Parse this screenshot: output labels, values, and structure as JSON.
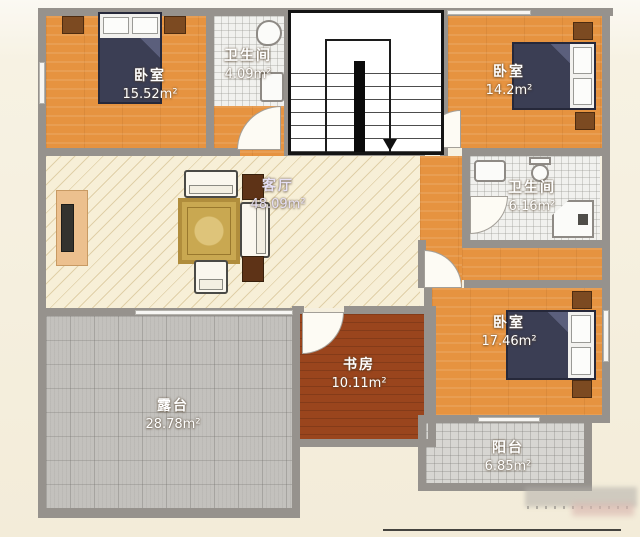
{
  "plan": {
    "type": "floor-plan",
    "unit": "m²",
    "rooms": [
      {
        "key": "bedroom-top-left",
        "name": "卧室",
        "area": "15.52m²"
      },
      {
        "key": "bathroom-top",
        "name": "卫生间",
        "area": "4.09m²"
      },
      {
        "key": "bedroom-top-right",
        "name": "卧室",
        "area": "14.2m²"
      },
      {
        "key": "living-room",
        "name": "客厅",
        "area": "48.09m²"
      },
      {
        "key": "bathroom-right",
        "name": "卫生间",
        "area": "6.16m²"
      },
      {
        "key": "bedroom-bottom-right",
        "name": "卧室",
        "area": "17.46m²"
      },
      {
        "key": "study",
        "name": "书房",
        "area": "10.11m²"
      },
      {
        "key": "terrace",
        "name": "露台",
        "area": "28.78m²"
      },
      {
        "key": "balcony",
        "name": "阳台",
        "area": "6.85m²"
      }
    ],
    "features": [
      "staircase-with-down-arrow",
      "double-beds-3",
      "nightstands",
      "sofa-set",
      "rug",
      "tv-cabinet",
      "toilet",
      "sink",
      "shower",
      "bathtub",
      "door-arcs",
      "windows"
    ],
    "colors": {
      "wall": "#96928d",
      "wood_floor": "#e69340",
      "living_floor": "#f7efd7",
      "study_floor": "#9a451d",
      "terrace_floor": "#c3c1bd",
      "balcony_floor": "#d7d6d2",
      "bath_floor": "#f1f1ee",
      "bed_blanket": "#3b3e54",
      "furniture_dark": "#5e3317",
      "rug": "#c9a851",
      "page_background": "#f3ecd9"
    }
  }
}
